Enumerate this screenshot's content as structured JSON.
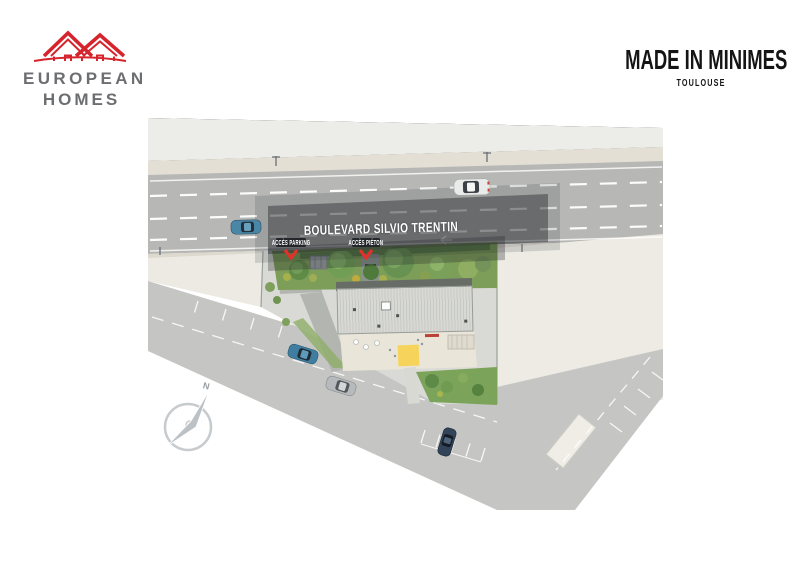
{
  "header": {
    "logo": {
      "line1": "EUROPEAN",
      "line2": "HOMES",
      "icon": "double-house-roofline-icon",
      "icon_color": "#d6242d",
      "text_color": "#6d6e71"
    },
    "project": {
      "title": "MADE IN MINIMES",
      "subtitle": "TOULOUSE",
      "text_color": "#141414"
    }
  },
  "plan": {
    "type": "aerial-residence-site-plan",
    "street_label": "BOULEVARD SILVIO TRENTIN",
    "access_parking_label": "ACCÈS PARKING",
    "access_pedestrian_label": "ACCÈS PIÉTON",
    "compass": {
      "north_label": "N"
    },
    "colors": {
      "boulevard_asphalt": "#b7b7b5",
      "side_street_asphalt": "#c5c6c4",
      "sidewalk": "#e3dfd4",
      "upper_block": "#ececе8",
      "parcel_beige": "#edebe4",
      "lawn_green": "#7d9e58",
      "roof_gray": "#d8d9d5",
      "terrace_beige": "#e9e5d9",
      "access_marker_red": "#e23128",
      "canopy_yellow": "#f6d45c",
      "lane_marking_white": "#ffffff"
    },
    "vehicles": [
      {
        "name": "sedan-blue-boulevard-westbound",
        "color": "#4a86a6"
      },
      {
        "name": "sedan-white-boulevard-eastbound",
        "color": "#e9ebea"
      },
      {
        "name": "sedan-teal-side-street",
        "color": "#3f7ea0"
      },
      {
        "name": "sedan-silver-side-street",
        "color": "#b6babc"
      },
      {
        "name": "sedan-navy-parked",
        "color": "#32445a"
      }
    ]
  }
}
